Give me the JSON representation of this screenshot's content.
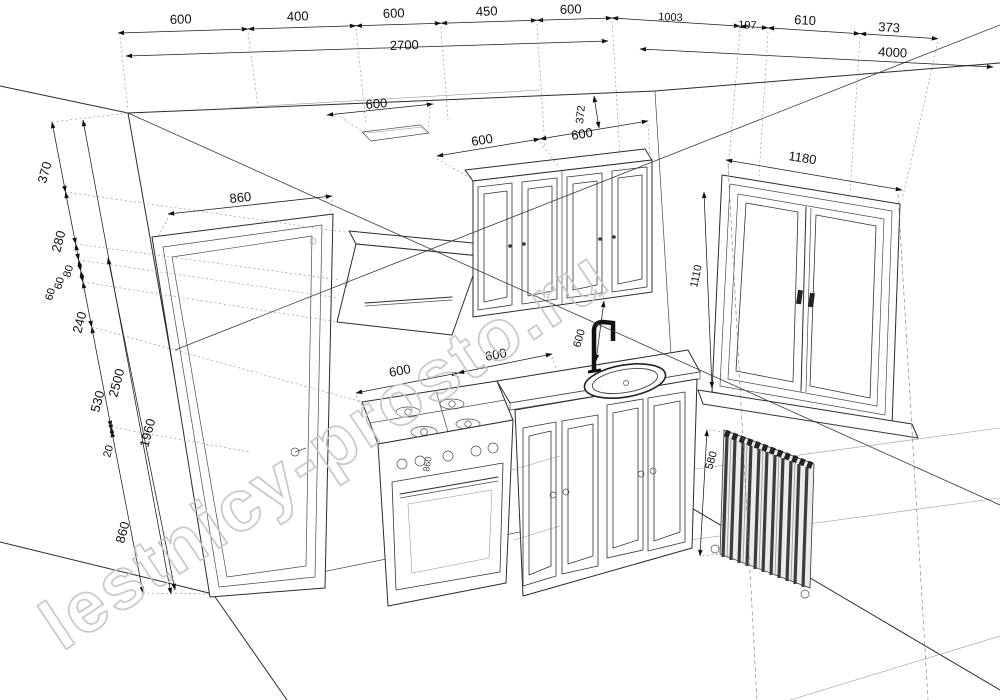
{
  "watermark": "lestnicy-prosto.ru",
  "drawing_title": "kitchen-perspective-plan",
  "dimensions": {
    "back_wall_top": {
      "segments": [
        "600",
        "400",
        "600",
        "450",
        "600"
      ],
      "total": "2700"
    },
    "right_wall_top": {
      "segments": [
        "1003",
        "197",
        "610",
        "373"
      ],
      "total": "4000"
    },
    "left_heights": {
      "segments": [
        "370",
        "280",
        "80",
        "60",
        "60",
        "240",
        "530",
        "20",
        "860"
      ],
      "wall_height": "2500",
      "door_opening": "1960"
    },
    "door_width": "860",
    "ceiling_span": "600",
    "wall_cabinets": {
      "left": "600",
      "right": "600",
      "height": "372"
    },
    "backsplash": "600",
    "base_run": {
      "stove": "600",
      "counter": "600"
    },
    "stove_height": "860",
    "window": {
      "width": "1180",
      "height": "1110"
    },
    "radiator_height": "580"
  }
}
